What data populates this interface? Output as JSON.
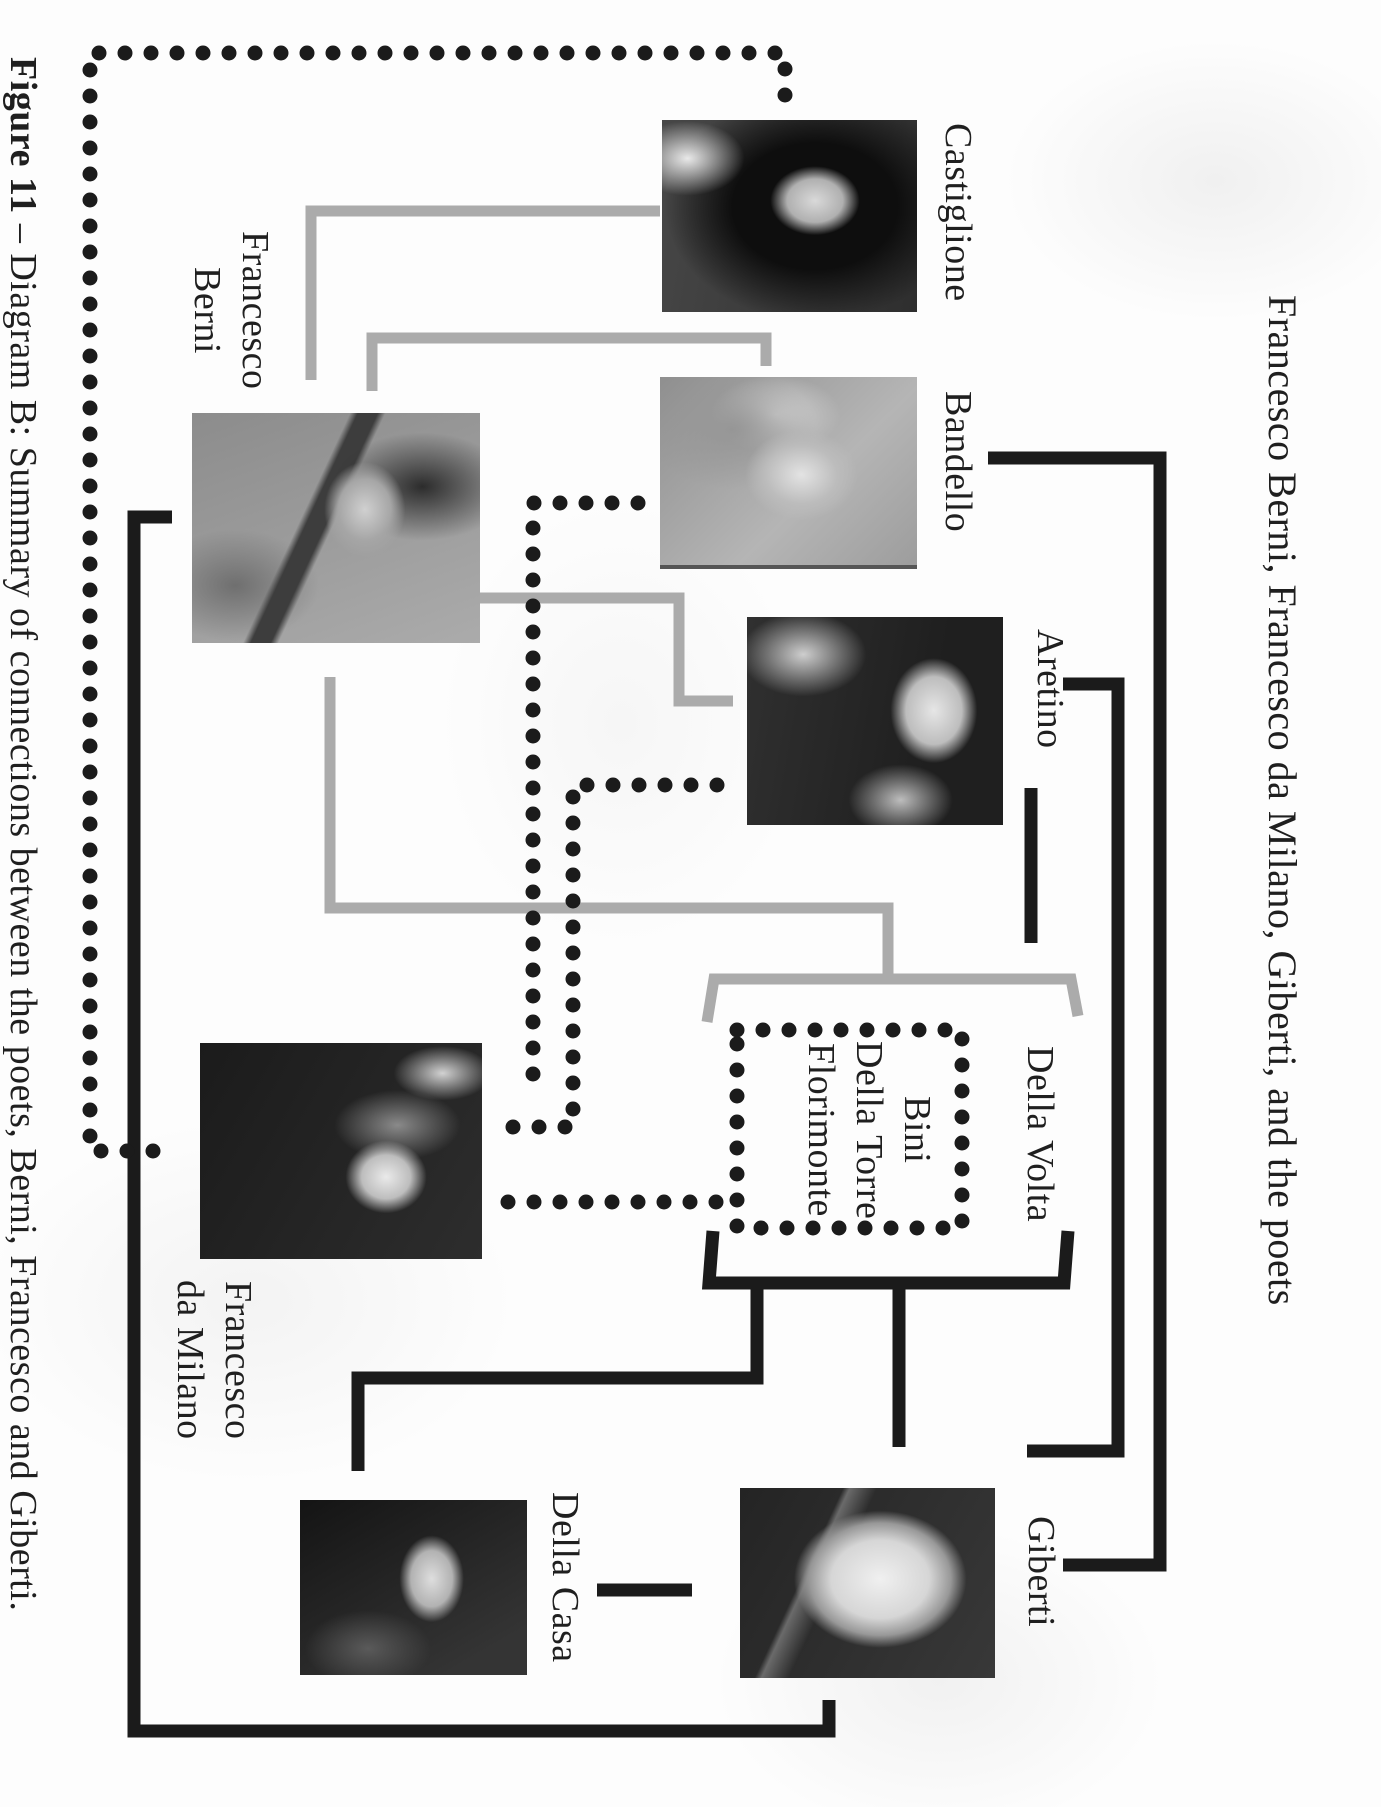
{
  "page": {
    "caption_bold": "Figure 11 ",
    "caption_rest": "– Diagram B: Summary of connections between the poets, Berni, Francesco and Giberti.",
    "title": "Francesco Berni, Francesco da Milano, Giberti, and the poets"
  },
  "nodes": {
    "castiglione": {
      "label": "Castiglione"
    },
    "bandello": {
      "label": "Bandello"
    },
    "aretino": {
      "label": "Aretino"
    },
    "berni": {
      "label": "Francesco\nBerni"
    },
    "della_volta": {
      "label": "Della Volta"
    },
    "group_box": {
      "label": "Bini\nDella Torre\nFlorimonte"
    },
    "da_milano": {
      "label": "Francesco\nda Milano"
    },
    "della_casa": {
      "label": "Della Casa"
    },
    "giberti": {
      "label": "Giberti"
    }
  },
  "colors": {
    "line_black": "#1b1b1b",
    "line_gray": "#ababab",
    "dot": "#1b1b1b",
    "text": "#1f1f1f"
  }
}
